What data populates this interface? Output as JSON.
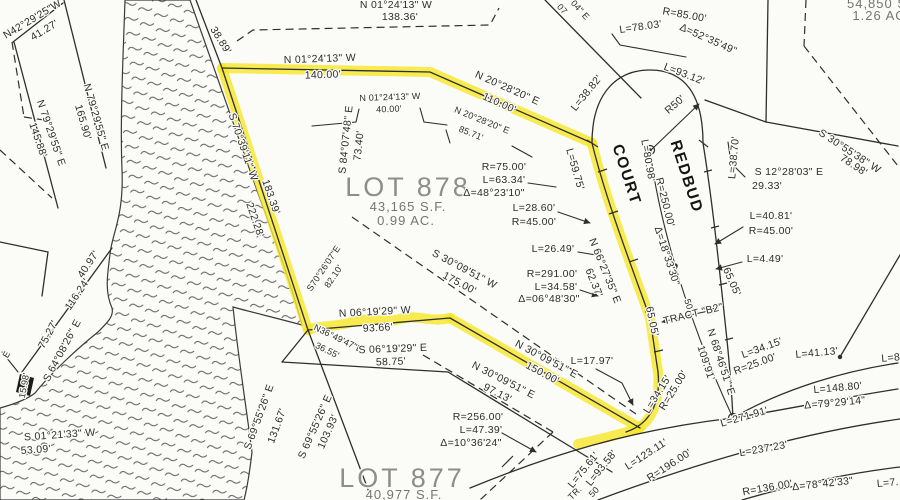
{
  "map": {
    "type": "subdivision-plat-survey",
    "background_color": "#fbfbf8",
    "line_color": "#2e2e2e",
    "highlight_color": "#f5e62c",
    "street": {
      "name": "REDBUD COURT"
    },
    "tract_label": "TRACT \"B2\"",
    "lots": [
      {
        "id": "lot-878",
        "name": "LOT 878",
        "area": "43,165 S.F.",
        "acreage": "0.99 AC."
      },
      {
        "id": "lot-877",
        "name": "LOT 877",
        "area": "40,977 S.F."
      },
      {
        "id": "lot-northeast-partial",
        "area": "54,850 S",
        "acreage": "1.26 AC"
      }
    ],
    "labels": [
      {
        "text": "N42°29'25\"W",
        "x": 34,
        "y": 22,
        "r": -31
      },
      {
        "text": "41.27'",
        "x": 46,
        "y": 33,
        "r": -31
      },
      {
        "text": "N 79°29'55\" E",
        "x": 93,
        "y": 118,
        "r": 74
      },
      {
        "text": "165.90'",
        "x": 80,
        "y": 123,
        "r": 74
      },
      {
        "text": "N 79°29'55\" E",
        "x": 48,
        "y": 134,
        "r": 71
      },
      {
        "text": "145.88'",
        "x": 35,
        "y": 141,
        "r": 71
      },
      {
        "text": "38.89'",
        "x": 218,
        "y": 42,
        "r": 58
      },
      {
        "text": "N 01°24'13\" W",
        "x": 396,
        "y": 8,
        "r": 0
      },
      {
        "text": "138.36'",
        "x": 400,
        "y": 20,
        "r": 0
      },
      {
        "text": "N 01°24'13\" W",
        "x": 320,
        "y": 62,
        "r": -2
      },
      {
        "text": "140.00'",
        "x": 323,
        "y": 78,
        "r": -2
      },
      {
        "text": "N 20°28'20\" E",
        "x": 506,
        "y": 91,
        "r": 24
      },
      {
        "text": "110.00'",
        "x": 498,
        "y": 106,
        "r": 24
      },
      {
        "text": "N 01°24'13\" W",
        "x": 390,
        "y": 100,
        "r": -2,
        "cls": "small"
      },
      {
        "text": "40.00'",
        "x": 389,
        "y": 112,
        "r": -2,
        "cls": "small"
      },
      {
        "text": "N 20°28'20\" E",
        "x": 481,
        "y": 123,
        "r": 22,
        "cls": "small"
      },
      {
        "text": "85.71'",
        "x": 470,
        "y": 136,
        "r": 22,
        "cls": "small"
      },
      {
        "text": "L=38.82'",
        "x": 589,
        "y": 95,
        "r": -51
      },
      {
        "text": "04\" E",
        "x": 578,
        "y": 12,
        "r": 48,
        "cls": "small"
      },
      {
        "text": "07",
        "x": 560,
        "y": 11,
        "r": 48,
        "cls": "small"
      },
      {
        "text": "L=78.03'",
        "x": 641,
        "y": 30,
        "r": -8
      },
      {
        "text": "R=85.00'",
        "x": 684,
        "y": 18,
        "r": 10
      },
      {
        "text": "Δ=52°35'49\"",
        "x": 707,
        "y": 42,
        "r": 24
      },
      {
        "text": "L=93.12'",
        "x": 683,
        "y": 77,
        "r": 21
      },
      {
        "text": "R50'",
        "x": 677,
        "y": 107,
        "r": -41
      },
      {
        "text": "54,850 S",
        "x": 877,
        "y": 8,
        "r": 0,
        "cls": "lot-sub"
      },
      {
        "text": "1.26 AC",
        "x": 879,
        "y": 20,
        "r": 0,
        "cls": "lot-sub"
      },
      {
        "text": "S 30°55'38\" W",
        "x": 848,
        "y": 154,
        "r": 33
      },
      {
        "text": "78.98'",
        "x": 852,
        "y": 168,
        "r": 33
      },
      {
        "text": "S 12°28'03\" E",
        "x": 789,
        "y": 175,
        "r": 0
      },
      {
        "text": "29.33'",
        "x": 767,
        "y": 189,
        "r": 0
      },
      {
        "text": "L=40.81'",
        "x": 771,
        "y": 219,
        "r": 0
      },
      {
        "text": "R=45.00'",
        "x": 771,
        "y": 234,
        "r": 0
      },
      {
        "text": "L=4.49'",
        "x": 765,
        "y": 262,
        "r": 0
      },
      {
        "text": "REDBUD",
        "x": 682,
        "y": 178,
        "r": 72,
        "cls": "street",
        "name": "street-name-redbud"
      },
      {
        "text": "COURT",
        "x": 622,
        "y": 176,
        "r": 72,
        "cls": "street",
        "name": "street-name-court"
      },
      {
        "text": "L=80.98'",
        "x": 645,
        "y": 161,
        "r": 80
      },
      {
        "text": "R=250.00'",
        "x": 662,
        "y": 203,
        "r": 76
      },
      {
        "text": "Δ=18°33'30\"",
        "x": 664,
        "y": 257,
        "r": 72
      },
      {
        "text": "L=59.75'",
        "x": 572,
        "y": 170,
        "r": 74
      },
      {
        "text": "L=38.70'",
        "x": 737,
        "y": 158,
        "r": -85
      },
      {
        "text": "65.05'",
        "x": 649,
        "y": 322,
        "r": 78
      },
      {
        "text": "65.05'",
        "x": 729,
        "y": 283,
        "r": 66
      },
      {
        "text": "50'",
        "x": 686,
        "y": 306,
        "r": 72,
        "cls": "small"
      },
      {
        "text": "TRACT \"B2\"",
        "x": 694,
        "y": 317,
        "r": -14,
        "name": "tract-b2-label"
      },
      {
        "text": "N 68°46'51\" E",
        "x": 718,
        "y": 363,
        "r": 72
      },
      {
        "text": "109.91'",
        "x": 703,
        "y": 364,
        "r": 72
      },
      {
        "text": "L=34.15'",
        "x": 660,
        "y": 396,
        "r": -58
      },
      {
        "text": "R=25.00'",
        "x": 676,
        "y": 392,
        "r": -58
      },
      {
        "text": "L=17.97'",
        "x": 592,
        "y": 364,
        "r": 0
      },
      {
        "text": "L=271.91'",
        "x": 745,
        "y": 420,
        "r": -16
      },
      {
        "text": "L=148.80'",
        "x": 838,
        "y": 391,
        "r": -5
      },
      {
        "text": "Δ=79°29'14\"",
        "x": 835,
        "y": 406,
        "r": -5
      },
      {
        "text": "L=41.13'",
        "x": 817,
        "y": 356,
        "r": -5
      },
      {
        "text": "L=34.15'",
        "x": 763,
        "y": 351,
        "r": -20
      },
      {
        "text": "R=25.00'",
        "x": 756,
        "y": 367,
        "r": -20
      },
      {
        "text": "L=8",
        "x": 891,
        "y": 361,
        "r": -5
      },
      {
        "text": "L=123.11'",
        "x": 648,
        "y": 457,
        "r": -33
      },
      {
        "text": "R=196.00'",
        "x": 671,
        "y": 468,
        "r": -33
      },
      {
        "text": "L=93.58'",
        "x": 604,
        "y": 470,
        "r": -51
      },
      {
        "text": "L=75.61'",
        "x": 586,
        "y": 472,
        "r": -51
      },
      {
        "text": "L=237.23'",
        "x": 764,
        "y": 452,
        "r": -10
      },
      {
        "text": "R=136.00'",
        "x": 768,
        "y": 491,
        "r": -10
      },
      {
        "text": "Δ=78°42'33\"",
        "x": 823,
        "y": 487,
        "r": -6
      },
      {
        "text": "L=7.",
        "x": 888,
        "y": 486,
        "r": -5
      },
      {
        "text": "TR.",
        "x": 577,
        "y": 495,
        "r": -45,
        "cls": "small"
      },
      {
        "text": "50",
        "x": 596,
        "y": 494,
        "r": -45,
        "cls": "small"
      },
      {
        "text": "LOT 878",
        "x": 408,
        "y": 196,
        "r": 0,
        "cls": "lot-title",
        "name": "lot-878-title"
      },
      {
        "text": "43,165 S.F.",
        "x": 408,
        "y": 211,
        "r": 0,
        "cls": "lot-sub",
        "name": "lot-878-area"
      },
      {
        "text": "0.99 AC.",
        "x": 406,
        "y": 225,
        "r": 0,
        "cls": "lot-sub",
        "name": "lot-878-acreage"
      },
      {
        "text": "LOT 877",
        "x": 402,
        "y": 487,
        "r": 0,
        "cls": "lot-title",
        "name": "lot-877-title"
      },
      {
        "text": "40,977 S.F.",
        "x": 404,
        "y": 499,
        "r": 0,
        "cls": "lot-sub",
        "name": "lot-877-area"
      },
      {
        "text": "S 84°07'48\" E",
        "x": 349,
        "y": 140,
        "r": -84
      },
      {
        "text": "73.40'",
        "x": 362,
        "y": 146,
        "r": -84
      },
      {
        "text": "S70°26'07\"E",
        "x": 326,
        "y": 270,
        "r": -56,
        "cls": "small"
      },
      {
        "text": "82.10'",
        "x": 336,
        "y": 278,
        "r": -56,
        "cls": "small"
      },
      {
        "text": "S 30°09'51\" W",
        "x": 463,
        "y": 272,
        "r": 28
      },
      {
        "text": "175.00'",
        "x": 458,
        "y": 286,
        "r": 28
      },
      {
        "text": "R=75.00'",
        "x": 504,
        "y": 170,
        "r": 0
      },
      {
        "text": "L=63.34'",
        "x": 504,
        "y": 183,
        "r": 0
      },
      {
        "text": "Δ=48°23'10\"",
        "x": 494,
        "y": 196,
        "r": 0
      },
      {
        "text": "L=28.60'",
        "x": 534,
        "y": 211,
        "r": 0
      },
      {
        "text": "R=45.00'",
        "x": 534,
        "y": 225,
        "r": 0
      },
      {
        "text": "L=26.49'",
        "x": 553,
        "y": 252,
        "r": 0
      },
      {
        "text": "R=291.00'",
        "x": 552,
        "y": 277,
        "r": 0
      },
      {
        "text": "L=34.58'",
        "x": 556,
        "y": 290,
        "r": 0
      },
      {
        "text": "Δ=06°48'30\"",
        "x": 549,
        "y": 302,
        "r": 0
      },
      {
        "text": "N 66°27'35\" E",
        "x": 602,
        "y": 272,
        "r": 68
      },
      {
        "text": "62.37'",
        "x": 591,
        "y": 284,
        "r": 68
      },
      {
        "text": "S 70°39'11\" W",
        "x": 240,
        "y": 148,
        "r": 71
      },
      {
        "text": "183.39'",
        "x": 268,
        "y": 198,
        "r": 71
      },
      {
        "text": "222.28'",
        "x": 252,
        "y": 221,
        "r": 71
      },
      {
        "text": "40.97'",
        "x": 91,
        "y": 266,
        "r": -56
      },
      {
        "text": "116.24'",
        "x": 80,
        "y": 296,
        "r": -56
      },
      {
        "text": "75.27'",
        "x": 51,
        "y": 336,
        "r": -62
      },
      {
        "text": "S 64°08'26\" E",
        "x": 65,
        "y": 352,
        "r": -62
      },
      {
        "text": "15.98'",
        "x": 27,
        "y": 386,
        "r": -80,
        "cls": "small"
      },
      {
        "text": "E",
        "x": 9,
        "y": 356,
        "r": -60,
        "cls": "small"
      },
      {
        "text": "S 01°21'33\" W",
        "x": 60,
        "y": 438,
        "r": -4
      },
      {
        "text": "53.09'",
        "x": 36,
        "y": 453,
        "r": -4
      },
      {
        "text": "S 69°55'26\" E",
        "x": 262,
        "y": 418,
        "r": -70
      },
      {
        "text": "131.67'",
        "x": 280,
        "y": 427,
        "r": -70
      },
      {
        "text": "S 69°55'26\" E",
        "x": 318,
        "y": 428,
        "r": -66
      },
      {
        "text": "103.93'",
        "x": 331,
        "y": 433,
        "r": -66
      },
      {
        "text": "N 06°19'29\" W",
        "x": 375,
        "y": 315,
        "r": -3
      },
      {
        "text": "93.66'",
        "x": 378,
        "y": 331,
        "r": -3
      },
      {
        "text": "N36°49'47\"E",
        "x": 337,
        "y": 341,
        "r": 26,
        "cls": "small"
      },
      {
        "text": "36.55'",
        "x": 326,
        "y": 353,
        "r": 26,
        "cls": "small"
      },
      {
        "text": "S 06°19'29\" E",
        "x": 393,
        "y": 352,
        "r": -2
      },
      {
        "text": "58.75'",
        "x": 391,
        "y": 365,
        "r": -2
      },
      {
        "text": "N 30°09'51\" E",
        "x": 502,
        "y": 383,
        "r": 27
      },
      {
        "text": "97.13'",
        "x": 496,
        "y": 396,
        "r": 27
      },
      {
        "text": "N 30°09'51\" E",
        "x": 545,
        "y": 362,
        "r": 28
      },
      {
        "text": "150.00'",
        "x": 541,
        "y": 376,
        "r": 28
      },
      {
        "text": "R=256.00'",
        "x": 478,
        "y": 420,
        "r": 0
      },
      {
        "text": "L=47.39'",
        "x": 481,
        "y": 433,
        "r": 0
      },
      {
        "text": "Δ=10°36'24\"",
        "x": 471,
        "y": 446,
        "r": 0
      }
    ]
  }
}
